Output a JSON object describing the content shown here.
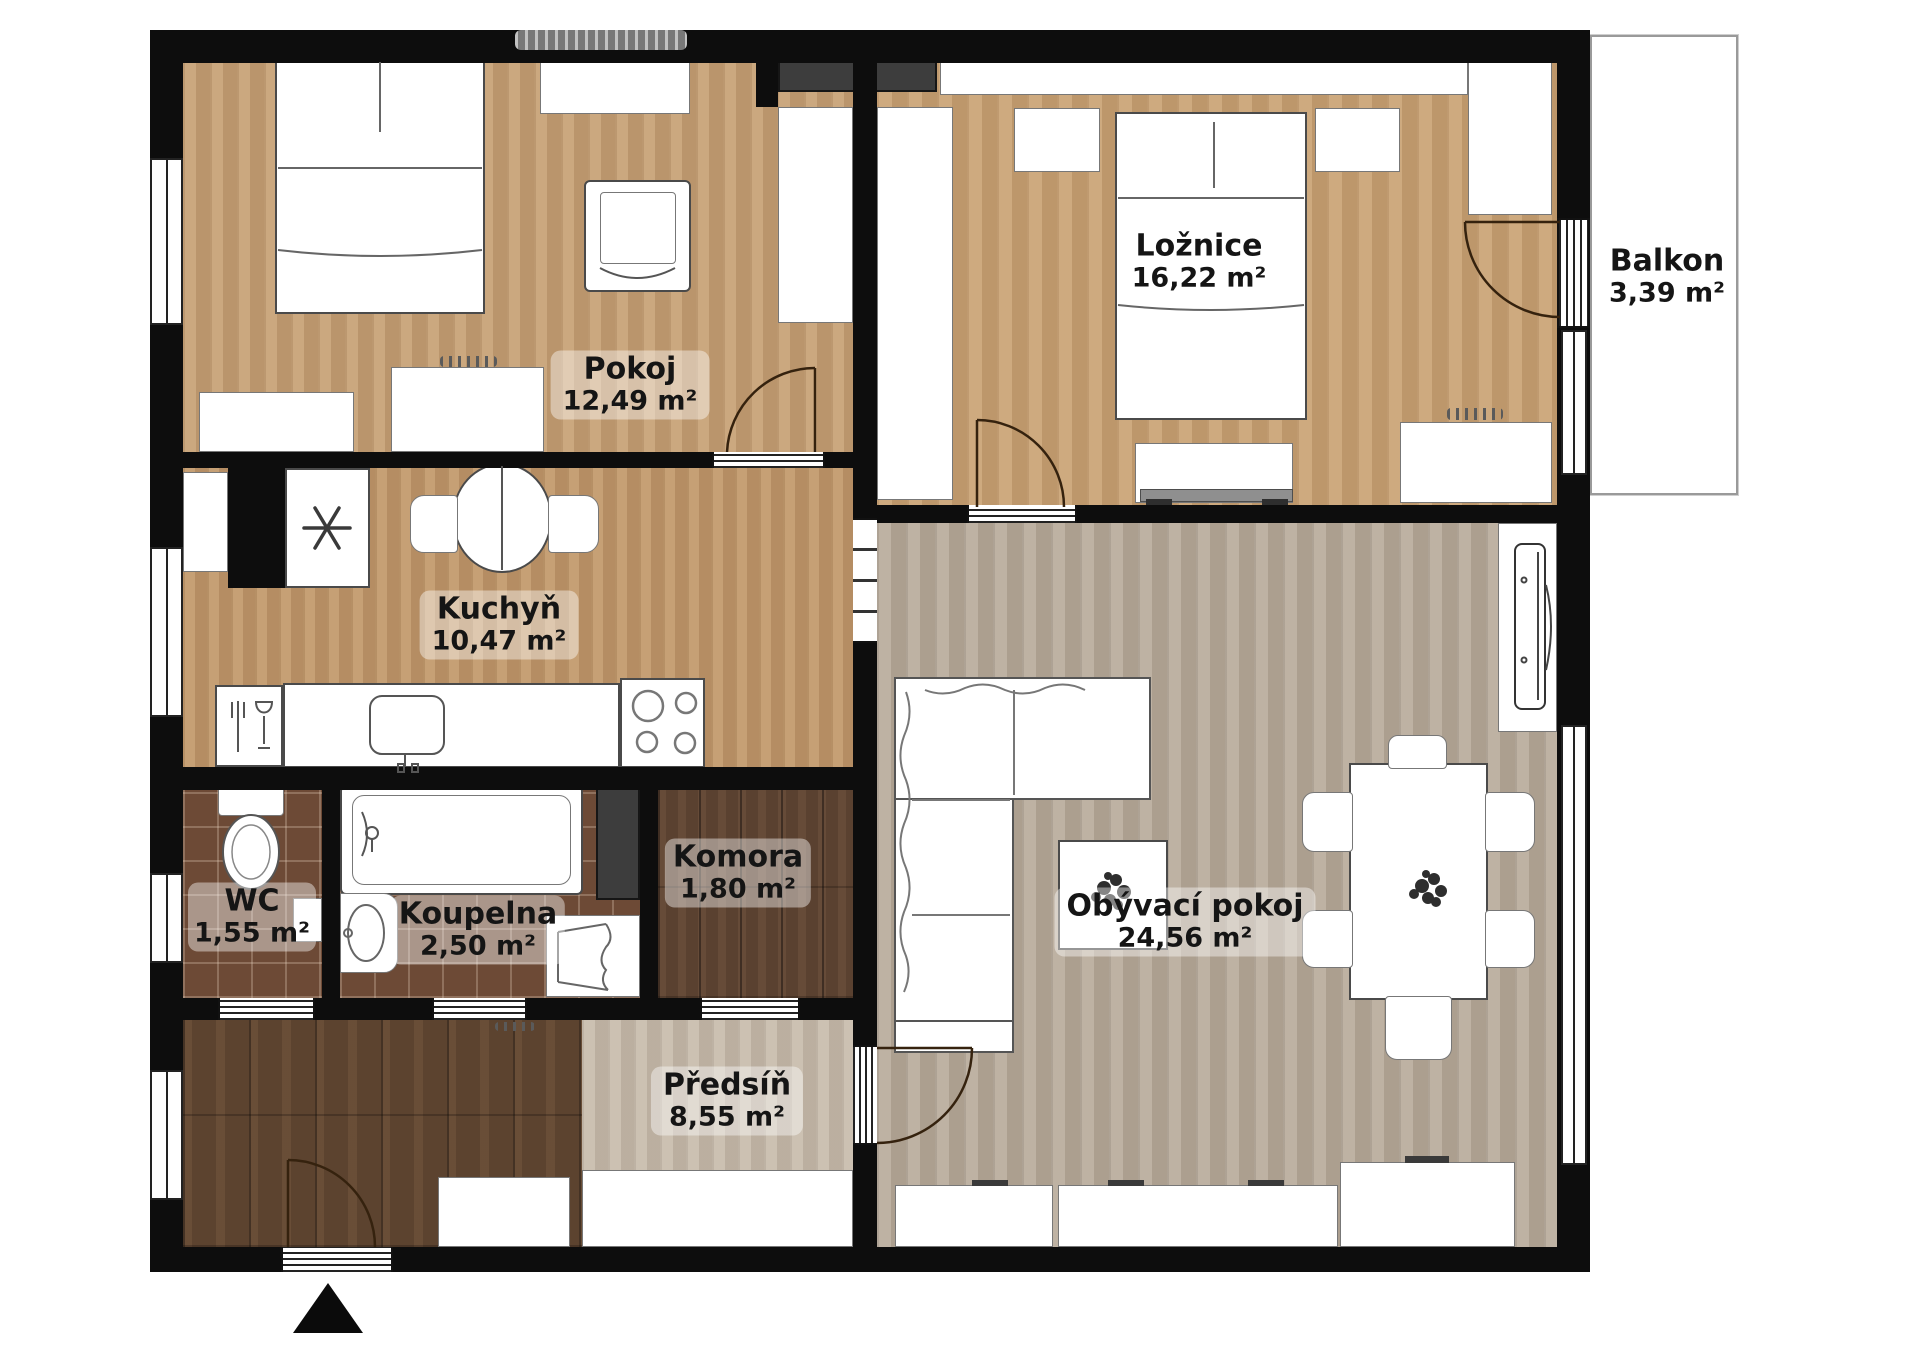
{
  "rooms": {
    "pokoj": {
      "name": "Pokoj",
      "area": "12,49 m²"
    },
    "loznice": {
      "name": "Ložnice",
      "area": "16,22 m²"
    },
    "balkon": {
      "name": "Balkon",
      "area": "3,39 m²"
    },
    "kuchyn": {
      "name": "Kuchyň",
      "area": "10,47 m²"
    },
    "wc": {
      "name": "WC",
      "area": "1,55 m²"
    },
    "koupelna": {
      "name": "Koupelna",
      "area": "2,50 m²"
    },
    "komora": {
      "name": "Komora",
      "area": "1,80 m²"
    },
    "predsin": {
      "name": "Předsíň",
      "area": "8,55 m²"
    },
    "obyvaci": {
      "name": "Obývací pokoj",
      "area": "24,56 m²"
    }
  },
  "icons": {
    "entrance_marker": "north-triangle",
    "fridge": "snowflake",
    "dishwasher": "fork-and-glass"
  },
  "colors": {
    "wall": "#0d0d0d",
    "floor_wood_tan": "#c49d72",
    "floor_wood_gray": "#b3a595",
    "floor_hall_light": "#c3b6a6",
    "floor_hall_dark": "#5c432f",
    "floor_tile": "#6d4a36",
    "furniture": "#ffffff"
  }
}
